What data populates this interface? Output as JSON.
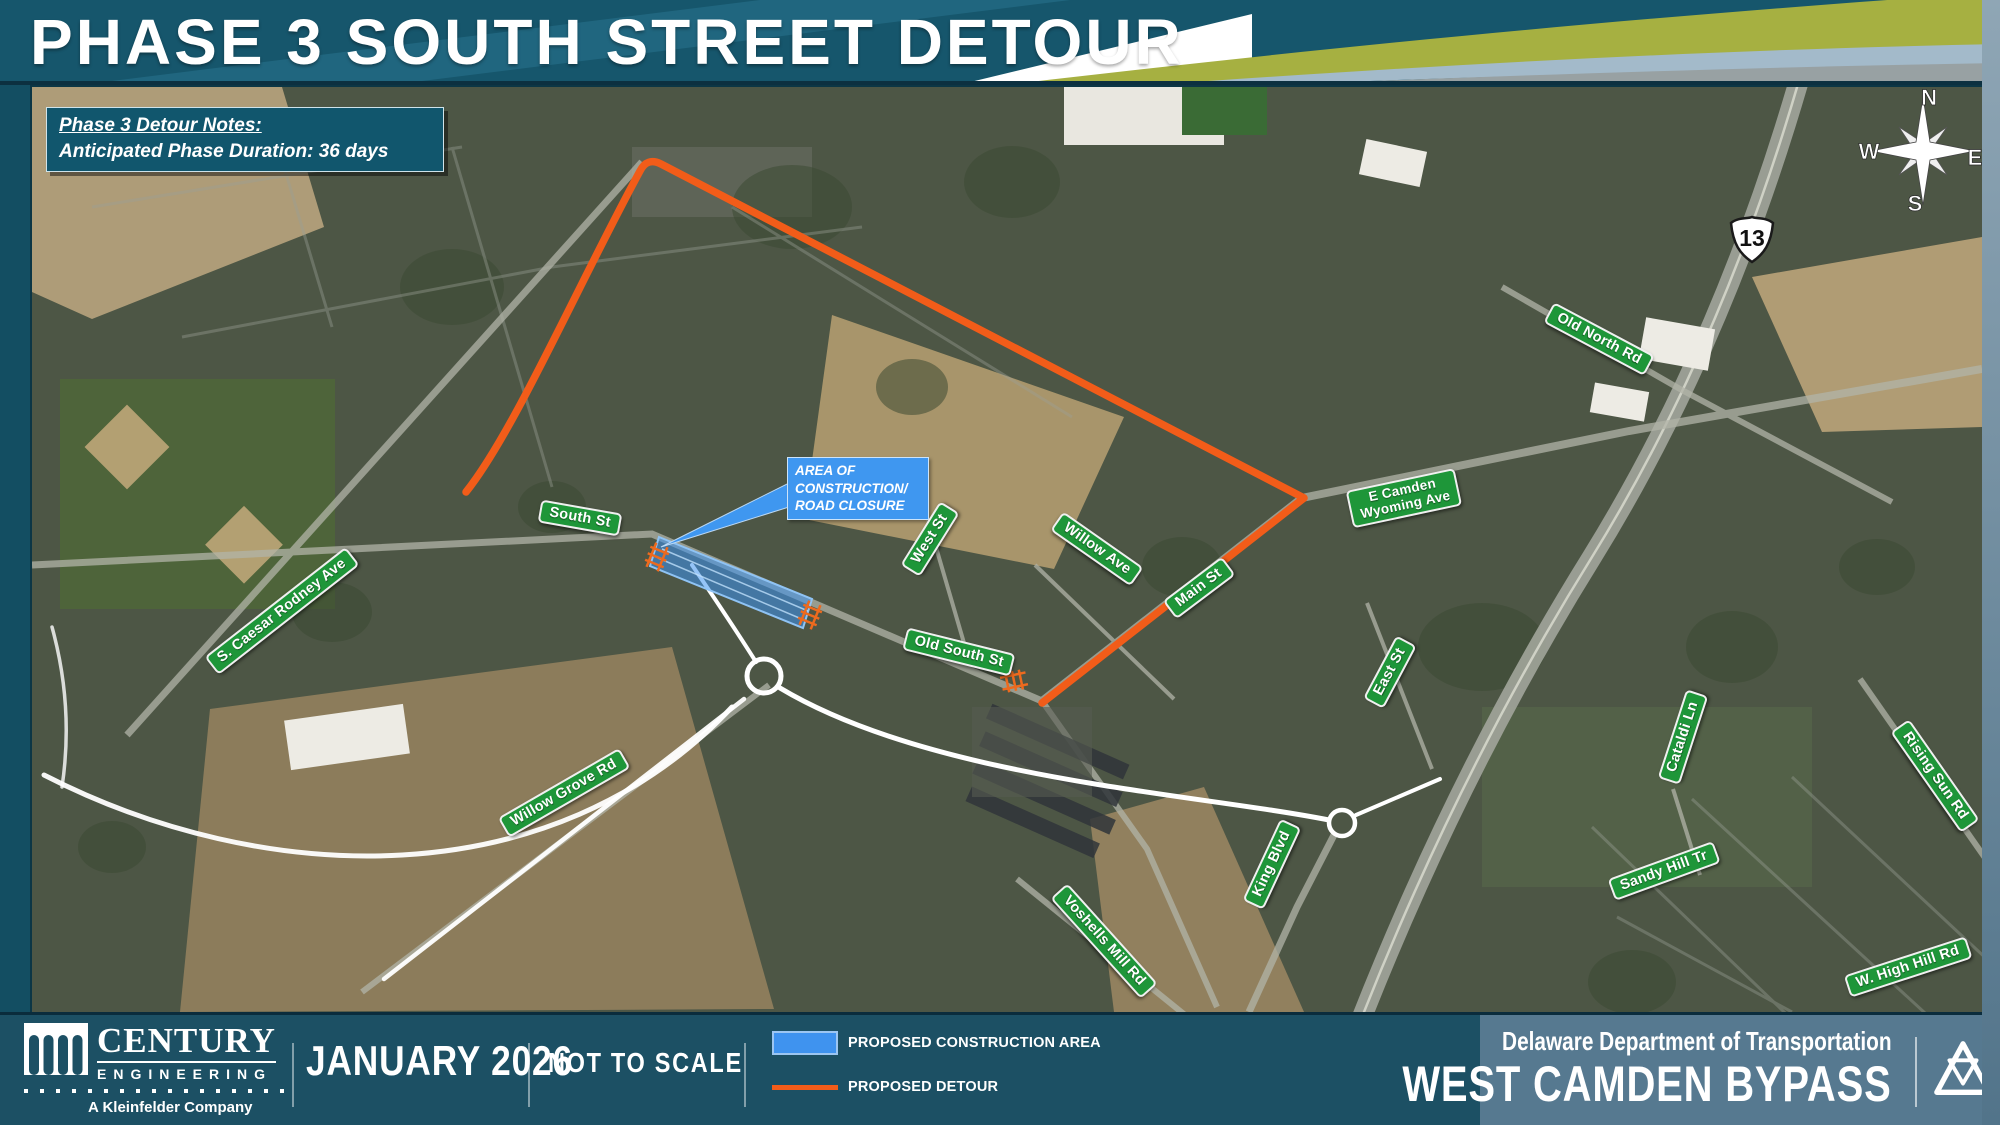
{
  "title": "PHASE 3 SOUTH STREET DETOUR",
  "notes": {
    "heading": "Phase 3 Detour Notes:",
    "duration": "Anticipated Phase Duration: 36 days"
  },
  "map": {
    "callout": {
      "line1": "AREA OF",
      "line2": "CONSTRUCTION/",
      "line3": "ROAD CLOSURE"
    },
    "route_shield": "13",
    "compass": {
      "n": "N",
      "e": "E",
      "s": "S",
      "w": "W"
    },
    "street_labels": [
      {
        "name": "South St"
      },
      {
        "name": "West St"
      },
      {
        "name": "Willow Ave"
      },
      {
        "name": "Main St"
      },
      {
        "name": "Old South St"
      },
      {
        "name": "E Camden",
        "name2": "Wyoming Ave"
      },
      {
        "name": "Old North Rd"
      },
      {
        "name": "S. Caesar Rodney Ave"
      },
      {
        "name": "Willow Grove Rd"
      },
      {
        "name": "King Blvd"
      },
      {
        "name": "Voshells Mill Rd"
      },
      {
        "name": "East St"
      },
      {
        "name": "Cataldi Ln"
      },
      {
        "name": "Rising Sun Rd"
      },
      {
        "name": "Sandy Hill Tr"
      },
      {
        "name": "W. High Hill Rd"
      }
    ]
  },
  "footer": {
    "logo": {
      "name": "CENTURY",
      "division": "ENGINEERING",
      "tagline": "A Kleinfelder Company"
    },
    "date": "JANUARY 2026",
    "scale_note": "NOT TO SCALE",
    "legend": [
      {
        "label": "PROPOSED CONSTRUCTION AREA",
        "color": "#3F93EF"
      },
      {
        "label": "PROPOSED DETOUR",
        "color": "#F25C19"
      }
    ],
    "agency": "Delaware Department of Transportation",
    "project": "WEST CAMDEN BYPASS"
  },
  "colors": {
    "sign_green": "#1E9639",
    "construction_blue": "#3F93EF",
    "detour_orange": "#F25C19",
    "banner_teal": "#16566C"
  }
}
